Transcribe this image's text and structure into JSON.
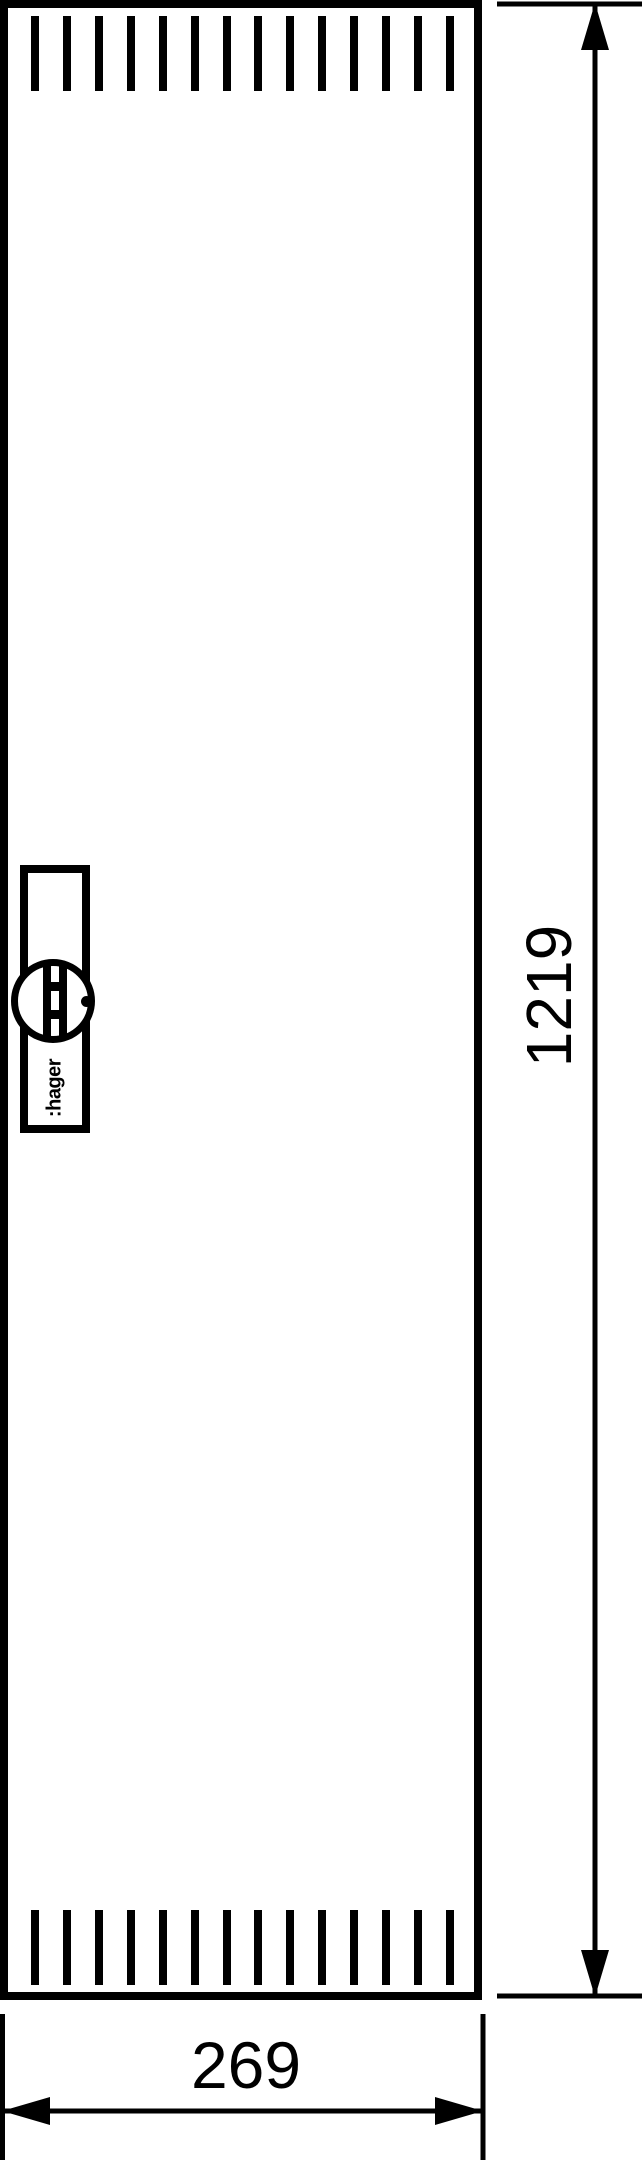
{
  "door": {
    "brand_label": ":hager",
    "vent_slot_count": 14
  },
  "dimensions": {
    "height_label": "1219",
    "width_label": "269"
  },
  "colors": {
    "ink": "#000000",
    "paper": "#ffffff"
  }
}
